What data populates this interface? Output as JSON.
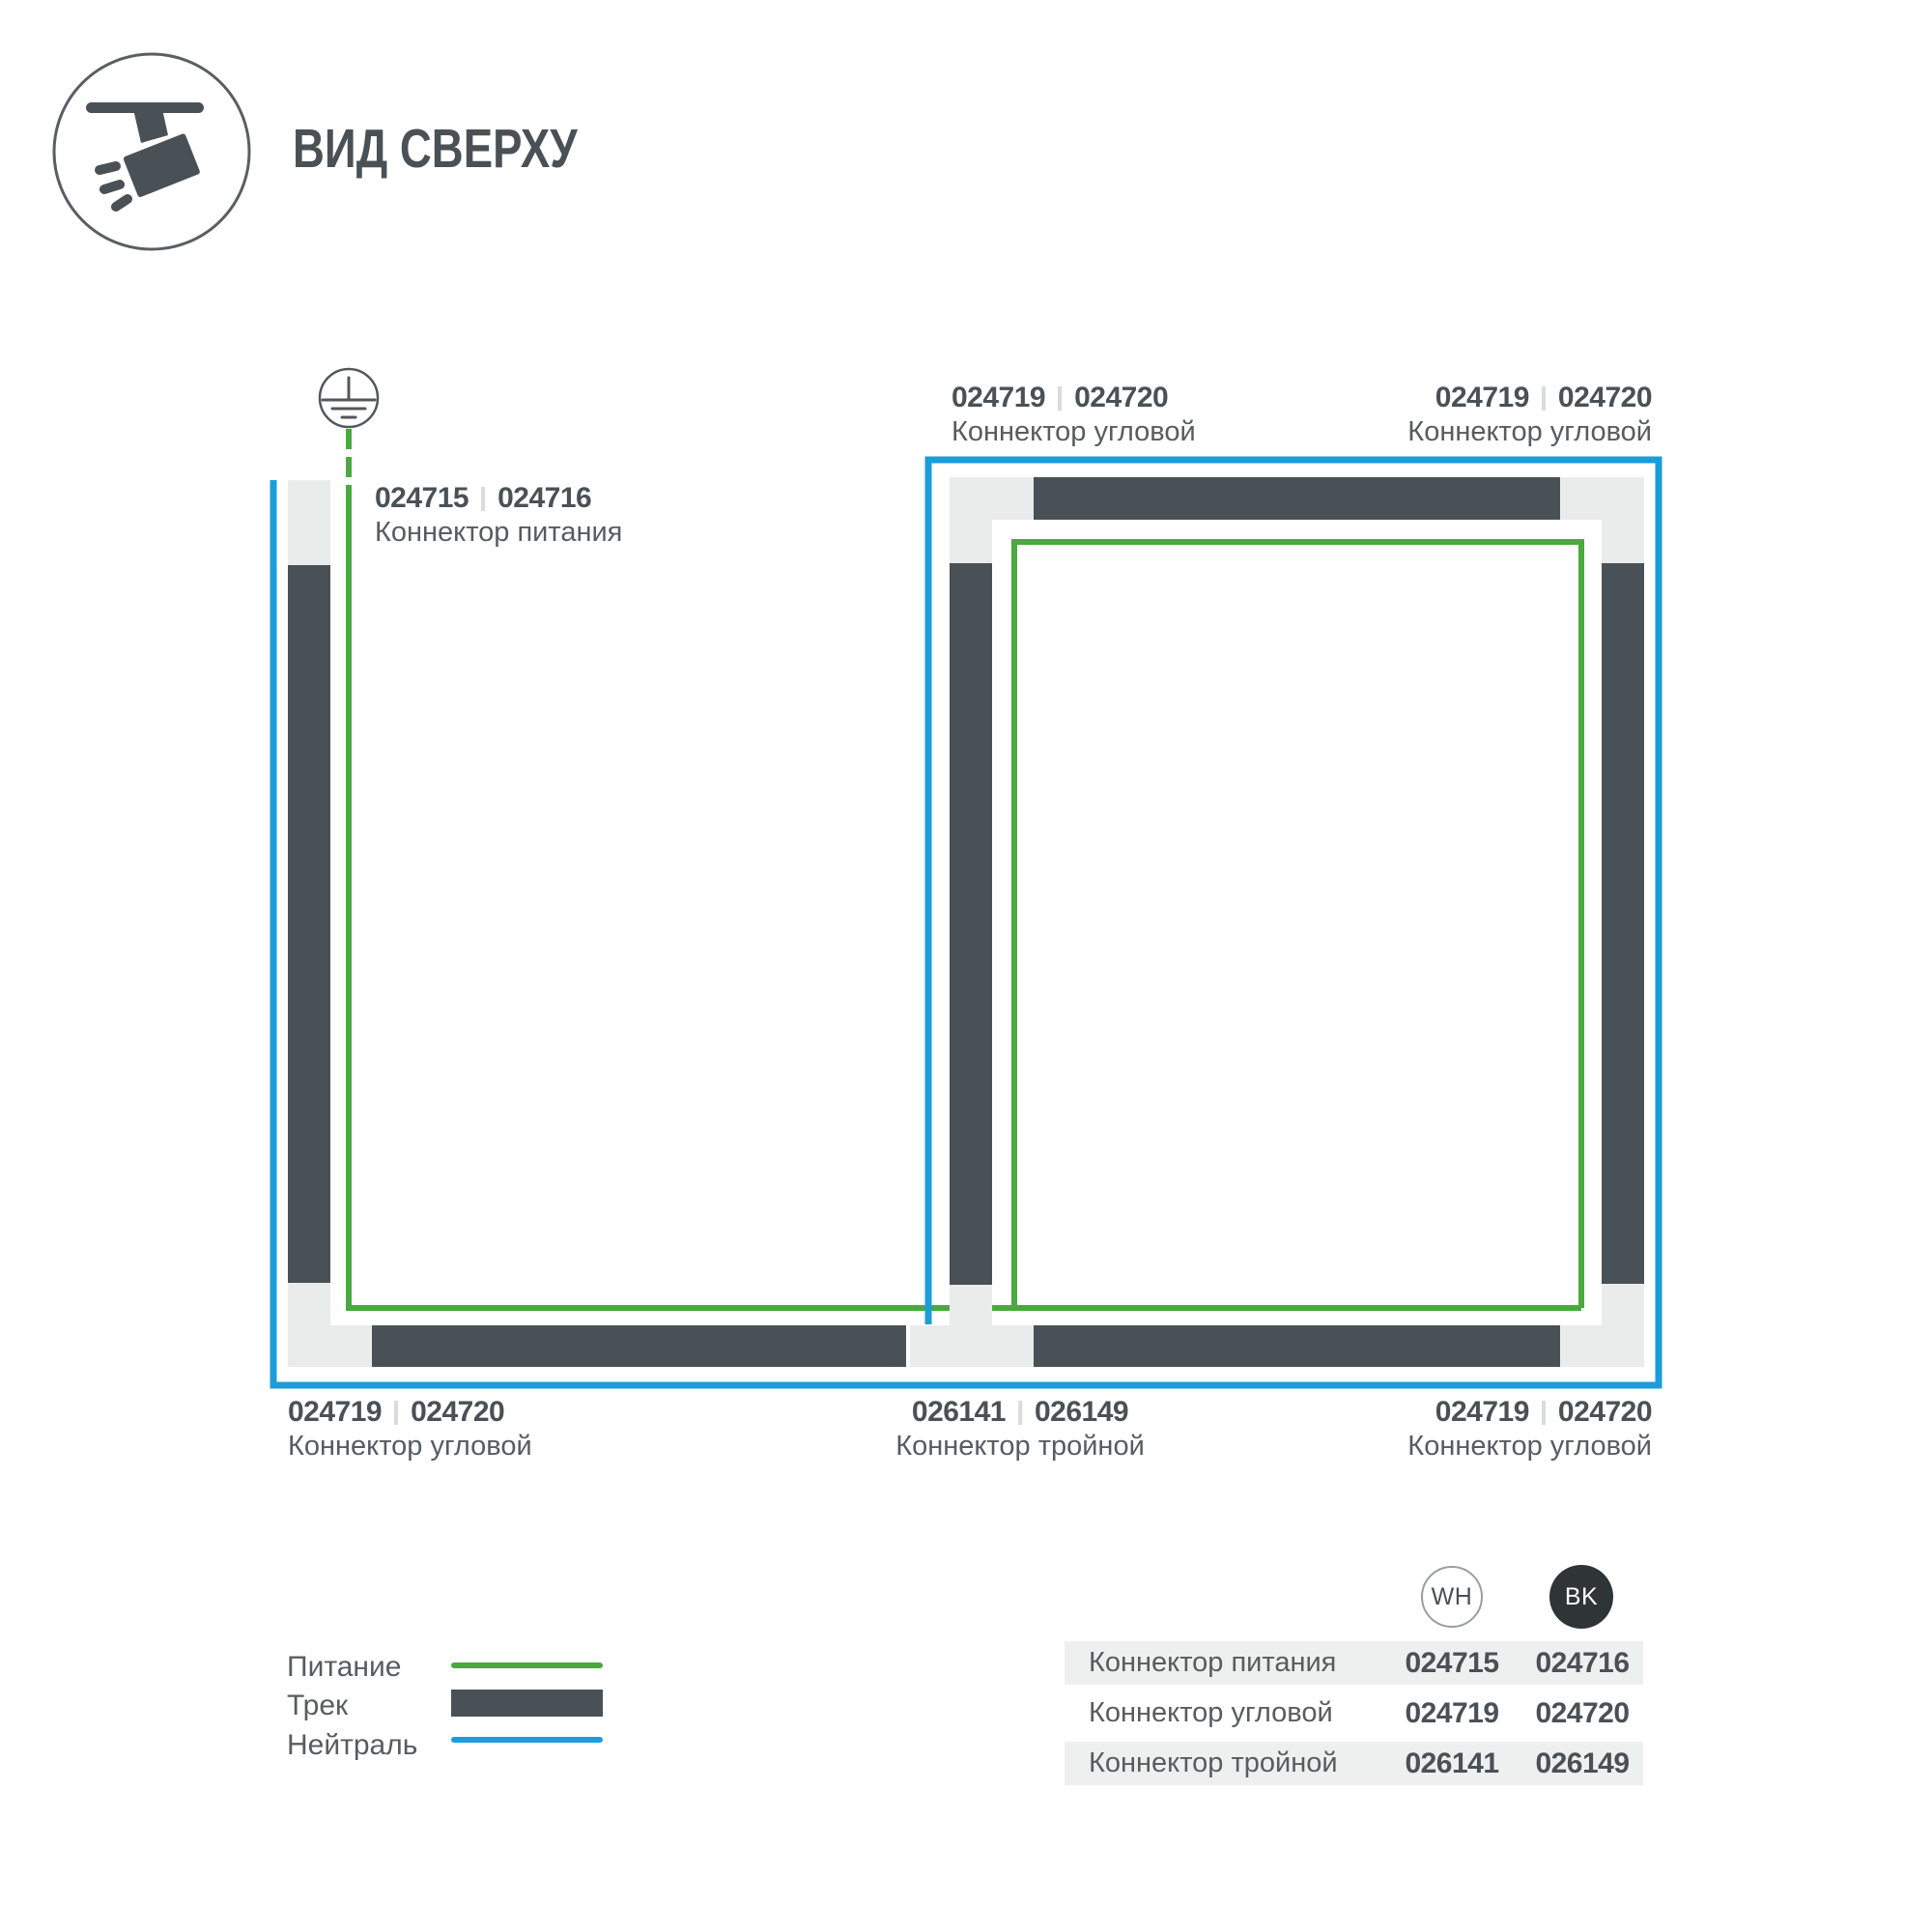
{
  "title": "ВИД СВЕРХУ",
  "colors": {
    "power_green": "#4aaa3d",
    "neutral_blue": "#1b9dd9",
    "track_dark": "#4a5156",
    "connector_gray": "#eaecec",
    "text_dark": "#4a5156",
    "text_medium": "#585c5f",
    "separator_gray": "#d8dcdb",
    "row_stripe": "#eef0ef",
    "bk_badge": "#2f3437"
  },
  "header_icon": "ceiling-track-spotlight",
  "diagram": {
    "ground_icon": "earth-ground-symbol",
    "labels": [
      {
        "wh": "024715",
        "bk": "024716",
        "name": "Коннектор питания"
      },
      {
        "wh": "024719",
        "bk": "024720",
        "name": "Коннектор угловой"
      },
      {
        "wh": "024719",
        "bk": "024720",
        "name": "Коннектор угловой"
      },
      {
        "wh": "024719",
        "bk": "024720",
        "name": "Коннектор угловой"
      },
      {
        "wh": "026141",
        "bk": "026149",
        "name": "Коннектор тройной"
      },
      {
        "wh": "024719",
        "bk": "024720",
        "name": "Коннектор угловой"
      }
    ]
  },
  "legend": {
    "items": [
      {
        "label": "Питание",
        "swatch": "power-line-green"
      },
      {
        "label": "Трек",
        "swatch": "track-bar-dark"
      },
      {
        "label": "Нейтраль",
        "swatch": "neutral-line-blue"
      }
    ]
  },
  "table": {
    "columns": [
      {
        "code": "WH"
      },
      {
        "code": "BK"
      }
    ],
    "rows": [
      {
        "name": "Коннектор питания",
        "wh": "024715",
        "bk": "024716"
      },
      {
        "name": "Коннектор угловой",
        "wh": "024719",
        "bk": "024720"
      },
      {
        "name": "Коннектор тройной",
        "wh": "026141",
        "bk": "026149"
      }
    ]
  }
}
